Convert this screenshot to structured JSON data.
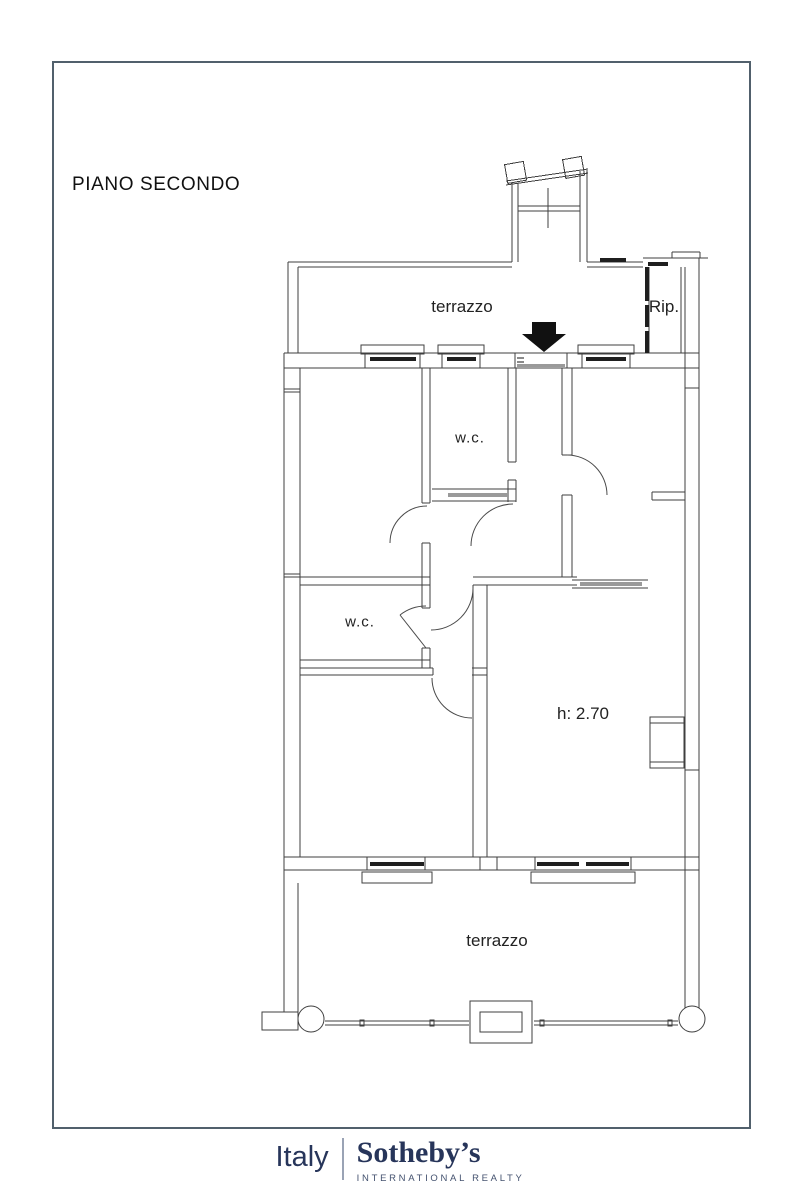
{
  "page": {
    "title_label": "PIANO SECONDO"
  },
  "floorplan": {
    "labels": {
      "terrace_top": "terrazzo",
      "storage": "Rip.",
      "wc_top": "w.c.",
      "wc_mid": "w.c.",
      "ceiling_height": "h: 2.70",
      "terrace_bottom": "terrazzo"
    },
    "icons": {
      "entrance_arrow": "down-arrow-entrance-marker"
    },
    "colors": {
      "wall_line": "#3f3f3f",
      "window_bar": "#1f1f1f",
      "sliding_door_gray": "#9a9a9a",
      "arrow_black": "#111111",
      "frame_border": "#51606c"
    }
  },
  "footer": {
    "brand_region": "Italy",
    "brand_name": "Sotheby’s",
    "brand_subtitle": "INTERNATIONAL REALTY",
    "brand_color": "#27355a"
  }
}
